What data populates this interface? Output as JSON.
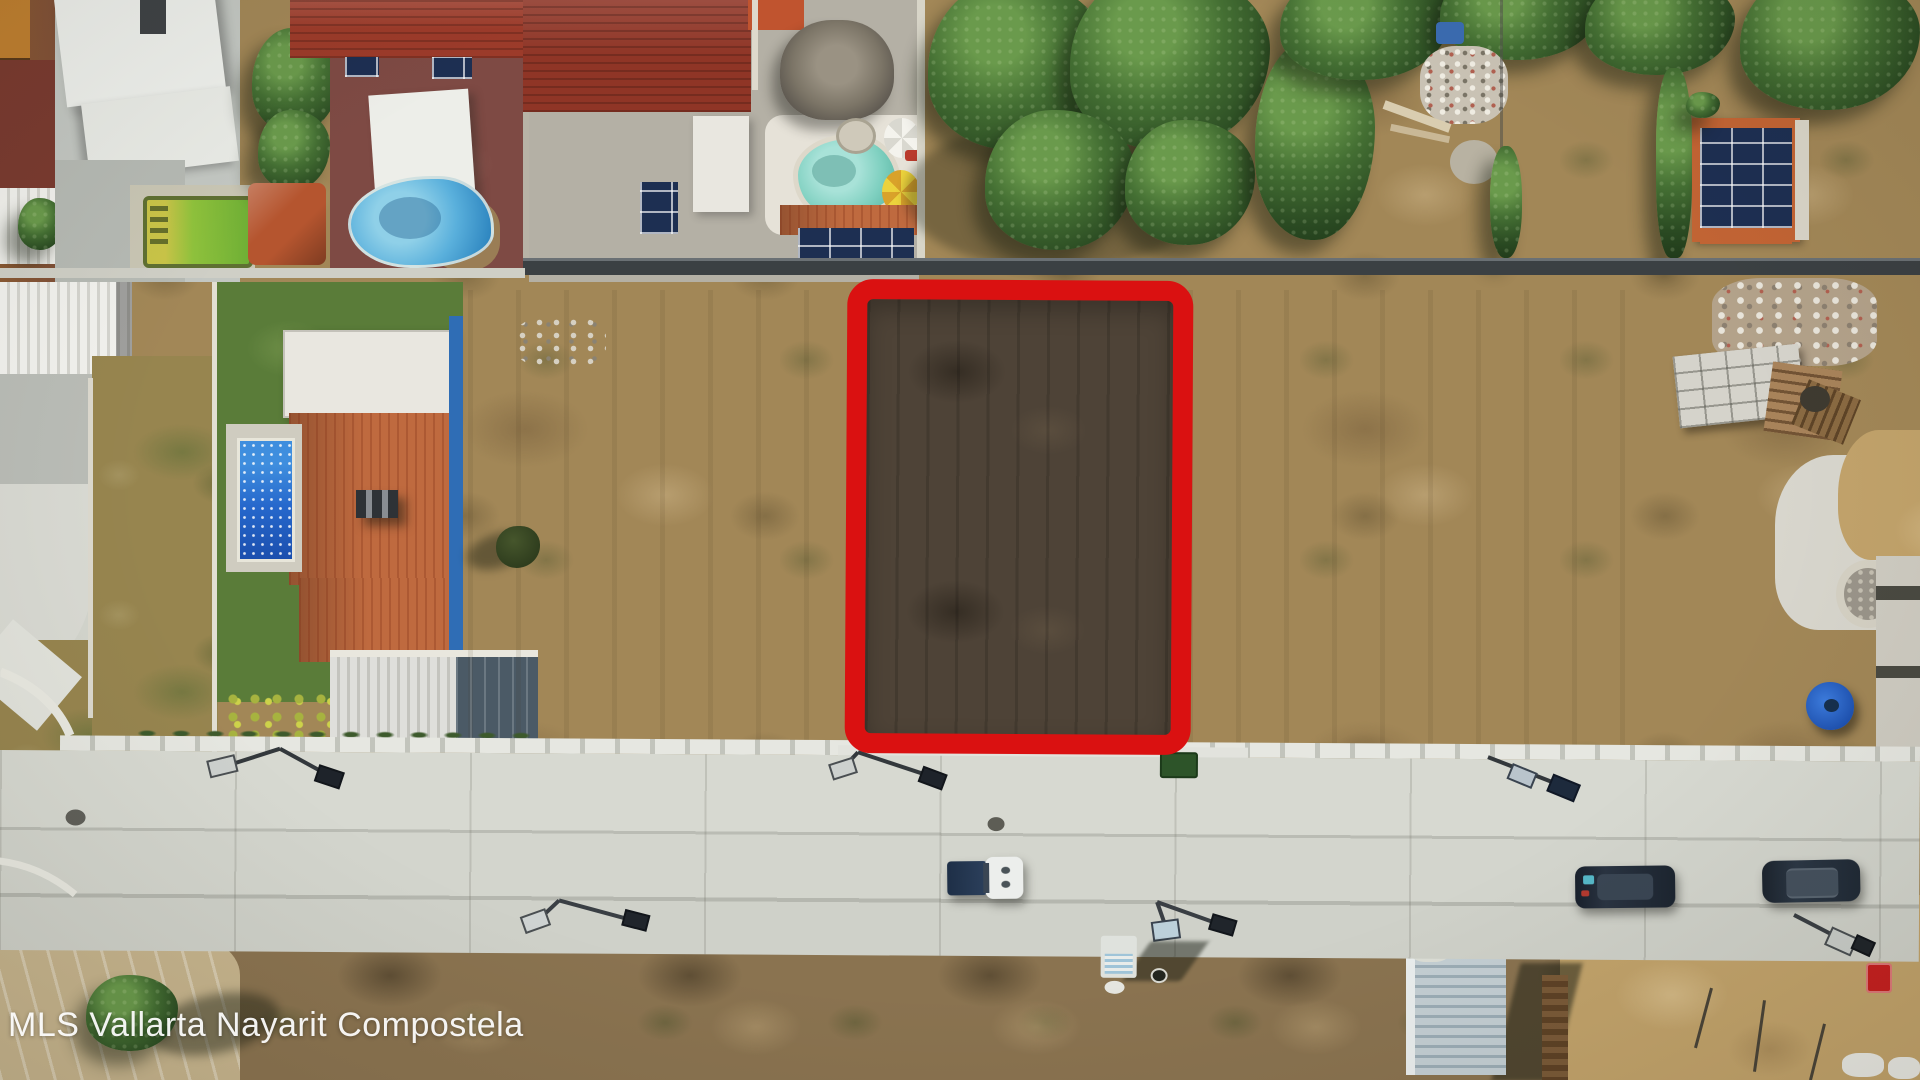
{
  "watermark": {
    "text": "MLS Vallarta Nayarit Compostela"
  },
  "highlight": {
    "shape": "rounded-rectangle-outline",
    "meaning": "advertised-vacant-lot"
  },
  "colors": {
    "lot-outline": "#da1111",
    "lot-soil": "#4e4337",
    "dirt": "#a28757",
    "sand": "#c2a36b",
    "concrete": "#d3d5cd",
    "grass": "#5a7c39",
    "roof-orange": "#bf6a3f",
    "roof-red": "#9c3b2a",
    "solar": "#1d2f52",
    "pool-blue": "#2668cc",
    "spa-turquoise": "#6cc4b4",
    "palapa-thatch": "#8a8274",
    "shed-roof-blue": "#9cadb6",
    "tree-green": "#2a4a22"
  }
}
